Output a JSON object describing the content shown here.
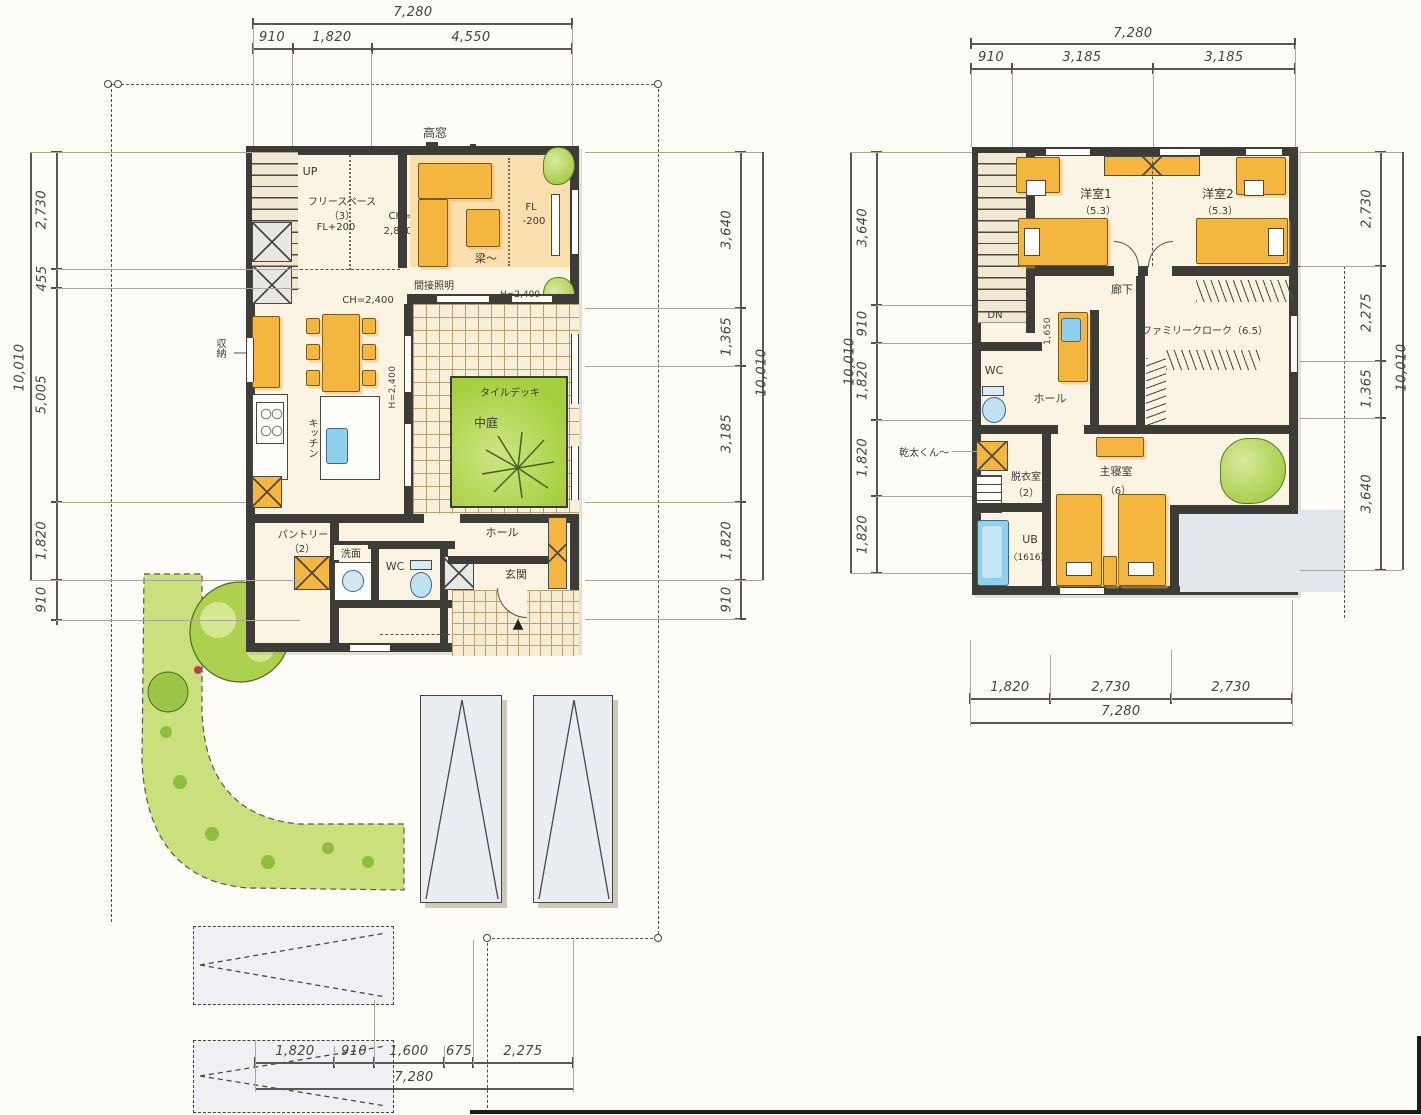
{
  "f1": {
    "dim_top": {
      "total": "7,280",
      "segs": [
        "910",
        "1,820",
        "4,550"
      ]
    },
    "dim_left": {
      "total": "10,010",
      "segs": [
        "2,730",
        "455",
        "5,005",
        "1,820",
        "910"
      ]
    },
    "dim_right": {
      "total": "10,010",
      "segs": [
        "3,640",
        "1,365",
        "3,185",
        "1,820",
        "910"
      ]
    },
    "dim_bottom": {
      "total": "7,280",
      "segs": [
        "1,820",
        "910",
        "1,600",
        "675",
        "2,275"
      ]
    },
    "labels": {
      "takamado": "高窓",
      "up": "UP",
      "free1": "フリースペース",
      "free2": "（3）",
      "free3": "FL+200",
      "ch2800a": "CH=",
      "ch2800b": "2,800",
      "fla": "FL",
      "flb": "-200",
      "hari": "梁〜",
      "kansetsu": "間接照明",
      "ch2400": "CH=2,400",
      "h2400": "H=2,400",
      "h2400v": "H=2,400",
      "shuno": "収納",
      "kitchen": "キッチン",
      "tiledeck": "タイルデッキ",
      "nakaniwa": "中庭",
      "pantry1": "パントリー",
      "pantry2": "（2）",
      "senmen": "洗面",
      "wc": "WC",
      "hall": "ホール",
      "genkan": "玄関"
    }
  },
  "f2": {
    "dim_top": {
      "total": "7,280",
      "segs": [
        "910",
        "3,185",
        "3,185"
      ]
    },
    "dim_left": {
      "total": "10,010",
      "segs": [
        "3,640",
        "910",
        "1,820",
        "1,820",
        "1,820"
      ]
    },
    "dim_right": {
      "total": "10,010",
      "segs": [
        "2,730",
        "2,275",
        "1,365",
        "3,640"
      ]
    },
    "dim_bottom": {
      "total": "7,280",
      "segs": [
        "1,820",
        "2,730",
        "2,730"
      ]
    },
    "labels": {
      "dn": "DN",
      "y1": "洋室1",
      "y1s": "（5.3）",
      "y2": "洋室2",
      "y2s": "（5.3）",
      "rouka": "廊下",
      "fc": "ファミリークローク（6.5）",
      "d1650": "1,650",
      "wc": "WC",
      "hall": "ホール",
      "kanta": "乾太くん〜",
      "datsui1": "脱衣室",
      "datsui2": "（2）",
      "ub1": "UB",
      "ub2": "〈1616〉",
      "master1": "主寝室",
      "master2": "（6）"
    }
  }
}
